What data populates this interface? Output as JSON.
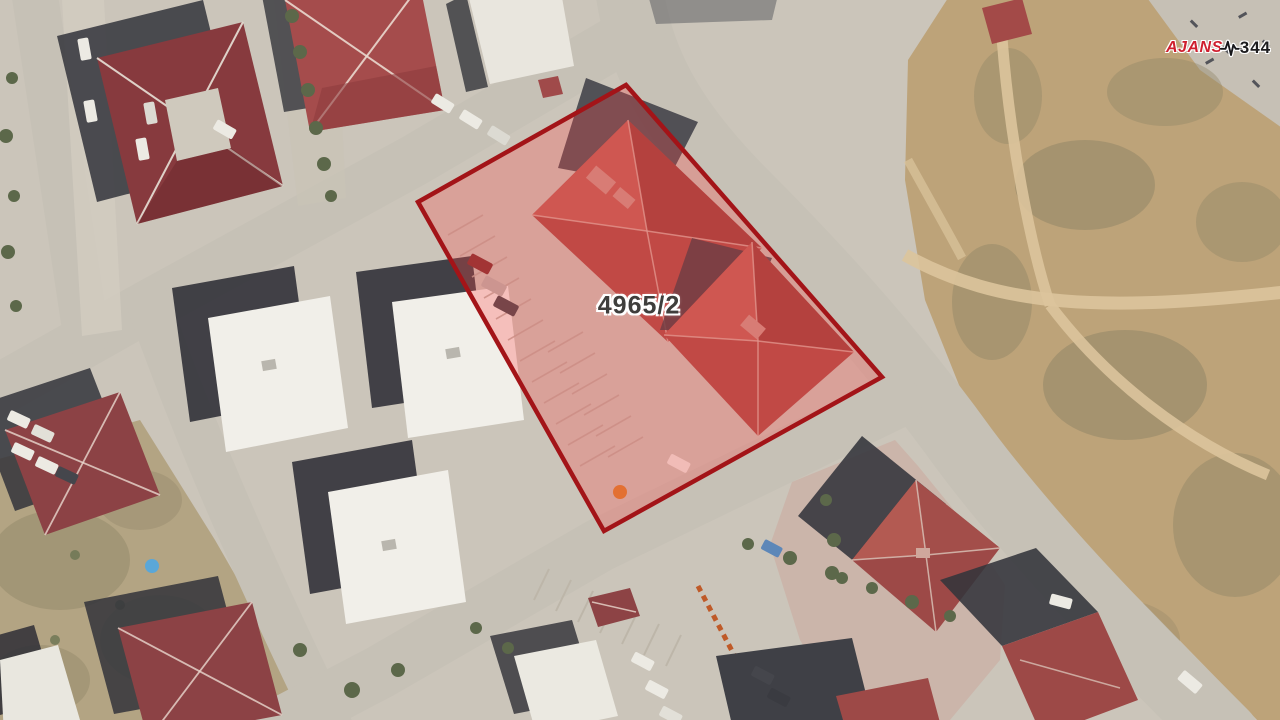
{
  "scene": {
    "description": "Aerial satellite view of a residential neighborhood with a highlighted cadastral parcel",
    "parcel": {
      "label": "4965/2",
      "outline_color": "#a31418",
      "fill_color": "rgba(255,70,70,0.28)",
      "label_color": "#3f3e3c"
    },
    "watermark": {
      "text_primary": "AJANS",
      "text_secondary": "344",
      "primary_color": "#cf1f2e",
      "secondary_color": "#1d1d1f",
      "icon": "pulse-icon"
    },
    "palette": {
      "ground": "#cbc5ba",
      "road": "#c6c1b6",
      "dirt_field": "#bda379",
      "scrub": "#b3a483",
      "roof_maroon": "#873a3e",
      "roof_red": "#a94b46",
      "building_white": "#f1efe9",
      "shadow": "#33343b",
      "vegetation": "#5c684a",
      "pavement_pink": "#cbb2a8"
    }
  }
}
